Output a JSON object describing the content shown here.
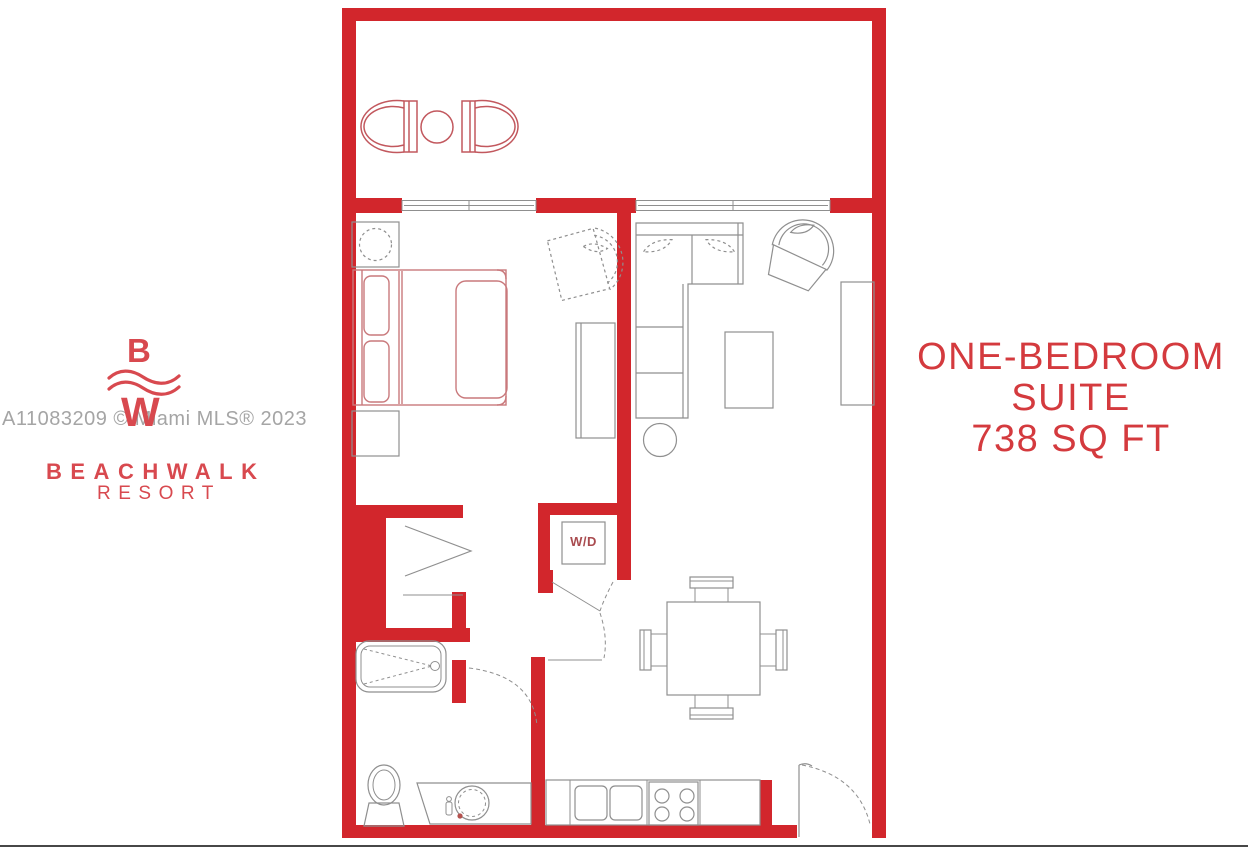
{
  "branding": {
    "logo_letter_top": "B",
    "logo_letter_bottom": "W",
    "resort_name": "BEACHWALK",
    "resort_subtitle": "RESORT"
  },
  "watermark": {
    "text": "A11083209 © Miami MLS® 2023"
  },
  "unit_title": {
    "line1": "ONE-BEDROOM",
    "line2": "SUITE",
    "line3": "738 SQ FT"
  },
  "plan_labels": {
    "washer_dryer": "W/D"
  },
  "colors": {
    "wall_red": "#d2262c",
    "furniture_gray": "#8f8f8f",
    "bed_red": "#c9797c",
    "balcony_red": "#c2585e",
    "title_red": "#d43a3e",
    "logo_red": "#d8494f",
    "watermark_gray": "#a5a5a5",
    "baseline_gray": "#474747",
    "faucet_red": "#b5524f",
    "wd_label_red": "#a94b4f",
    "page_bg": "#ffffff"
  }
}
